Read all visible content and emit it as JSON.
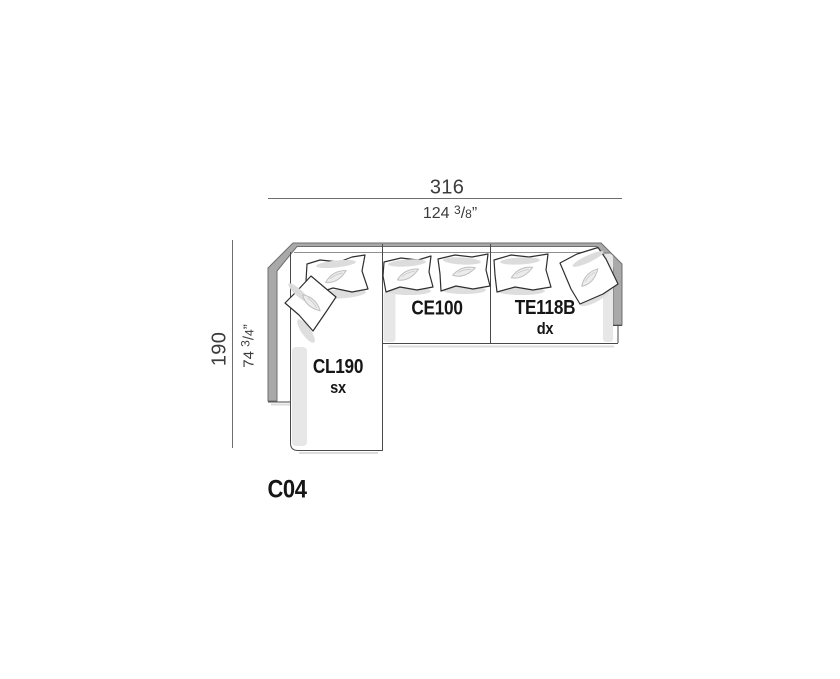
{
  "diagram": {
    "configuration_code": "C04",
    "width_dimension": {
      "cm": "316",
      "in_whole": "124",
      "in_frac_num": "3",
      "in_frac_slash": "/",
      "in_frac_den": "8",
      "in_unit": "”"
    },
    "depth_dimension": {
      "cm": "190",
      "in_whole": "74",
      "in_frac_num": "3",
      "in_frac_slash": "/",
      "in_frac_den": "4",
      "in_unit": "”"
    },
    "modules": {
      "chaise": {
        "code": "CL190",
        "side": "sx"
      },
      "center": {
        "code": "CE100"
      },
      "end": {
        "code": "TE118B",
        "side": "dx"
      }
    },
    "colors": {
      "outline": "#3f3f3f",
      "band_gray": "#a9a9a9",
      "shadow_gray": "#e7e7e7",
      "dimension_text": "#3c3c3c",
      "label_text": "#161616",
      "background": "#ffffff"
    }
  }
}
